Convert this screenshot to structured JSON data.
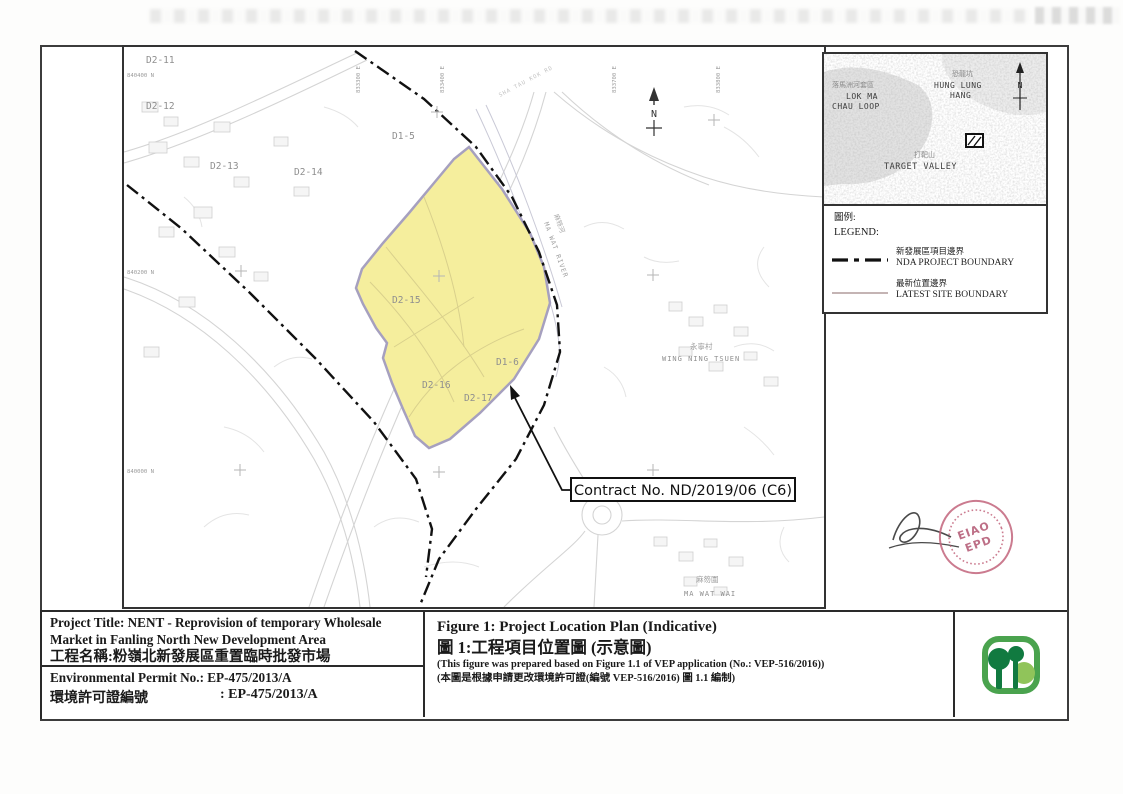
{
  "map": {
    "areas": {
      "d2_11": "D2-11",
      "d2_12": "D2-12",
      "d2_13": "D2-13",
      "d2_14": "D2-14",
      "d1_5": "D1-5",
      "d2_15": "D2-15",
      "d1_6": "D1-6",
      "d2_16": "D2-16",
      "d2_17": "D2-17"
    },
    "grid": {
      "n1": "840400 N",
      "n2": "840200 N",
      "n3": "840000 N",
      "e1": "833300 E",
      "e2": "833400 E",
      "e3": "833700 E",
      "e4": "833800 E"
    },
    "north_label": "N",
    "river_cn": "麻笏河",
    "river_en": "MA WAT RIVER",
    "road_label": "SHA TAU KOK RD",
    "wing_ning_cn": "永寧村",
    "wing_ning_en": "WING NING TSUEN",
    "ma_wat_cn": "麻笏圍",
    "ma_wat_en": "MA WAT WAI",
    "callout_text": "Contract No. ND/2019/06 (C6)",
    "site_fill": "#f5ee9d",
    "site_stroke": "#a6a0bf",
    "boundary_color": "#111111"
  },
  "inset": {
    "lok_ma_cn": "落馬洲河套區",
    "lok_ma_en1": "LOK MA",
    "lok_ma_en2": "CHAU LOOP",
    "hung_lung_cn": "恐龍坑",
    "hung_lung_en1": "HUNG LUNG",
    "hung_lung_en2": "HANG",
    "target_cn": "打靶山",
    "target_en": "TARGET VALLEY",
    "north_label": "N"
  },
  "legend": {
    "title_cn": "圖例:",
    "title_en": "LEGEND:",
    "item1_cn": "新發展區項目邊界",
    "item1_en": "NDA PROJECT BOUNDARY",
    "item2_cn": "最新位置邊界",
    "item2_en": "LATEST SITE BOUNDARY"
  },
  "stamp": {
    "line1": "EIAO",
    "line2": "EPD"
  },
  "titleblock": {
    "project_en": "Project Title: NENT - Reprovision of temporary Wholesale Market in Fanling North New Development Area",
    "project_cn": "工程名稱:粉嶺北新發展區重置臨時批發市場",
    "permit_en": "Environmental Permit No.: EP-475/2013/A",
    "permit_cn_label": "環境許可證編號",
    "permit_cn_value": ": EP-475/2013/A",
    "figure_en": "Figure 1: Project Location Plan (Indicative)",
    "figure_cn": "圖 1:工程項目位置圖 (示意圖)",
    "note_en": "(This figure was prepared based on Figure 1.1 of VEP application (No.: VEP-516/2016))",
    "note_cn": "(本圖是根據申請更改環境許可證(編號 VEP-516/2016) 圖 1.1 編制)"
  }
}
